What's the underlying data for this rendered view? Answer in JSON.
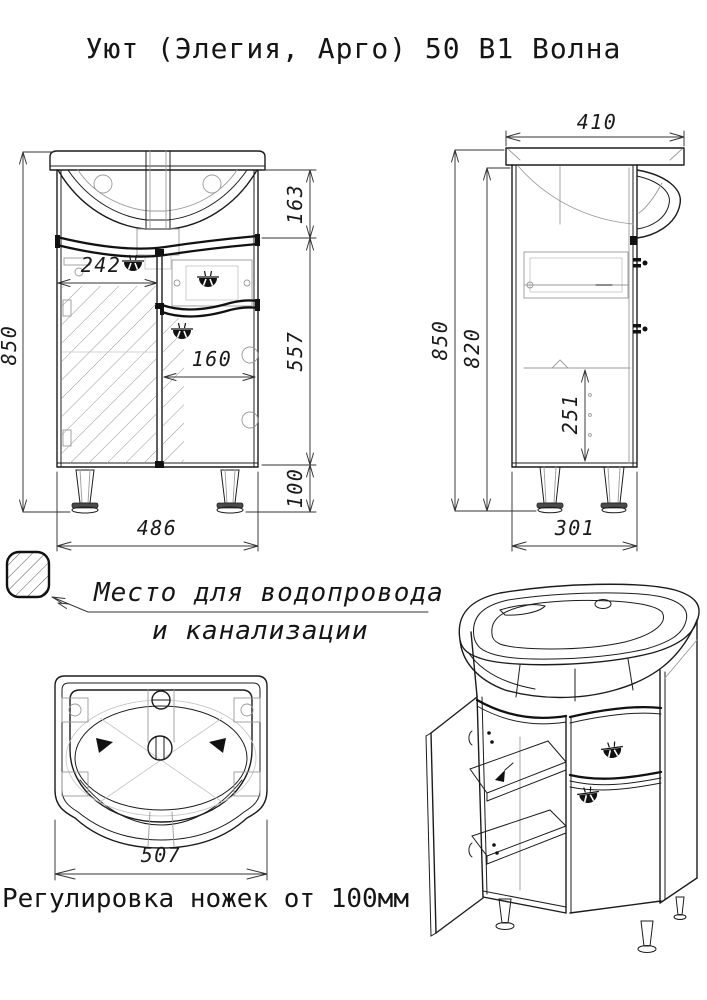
{
  "title": "Уют (Элегия, Арго) 50 В1 Волна",
  "front_view": {
    "dims": {
      "overall_height": "850",
      "sink_section_height": "163",
      "body_height": "557",
      "leg_height": "100",
      "left_door_width": "242",
      "right_door_width": "160",
      "overall_width": "486"
    }
  },
  "side_view": {
    "dims": {
      "depth": "410",
      "overall_height": "850",
      "carcass_height": "820",
      "shelf_clearance": "251",
      "body_depth": "301"
    }
  },
  "top_view": {
    "dims": {
      "sink_width": "507"
    }
  },
  "legend": {
    "hatch_note_line1": "Место для водопровода",
    "hatch_note_line2": "и канализации"
  },
  "footnote": "Регулировка ножек от 100мм",
  "colors": {
    "ink": "#1c1c1c",
    "thin_ink": "#9a9a9a",
    "paper": "#ffffff"
  }
}
